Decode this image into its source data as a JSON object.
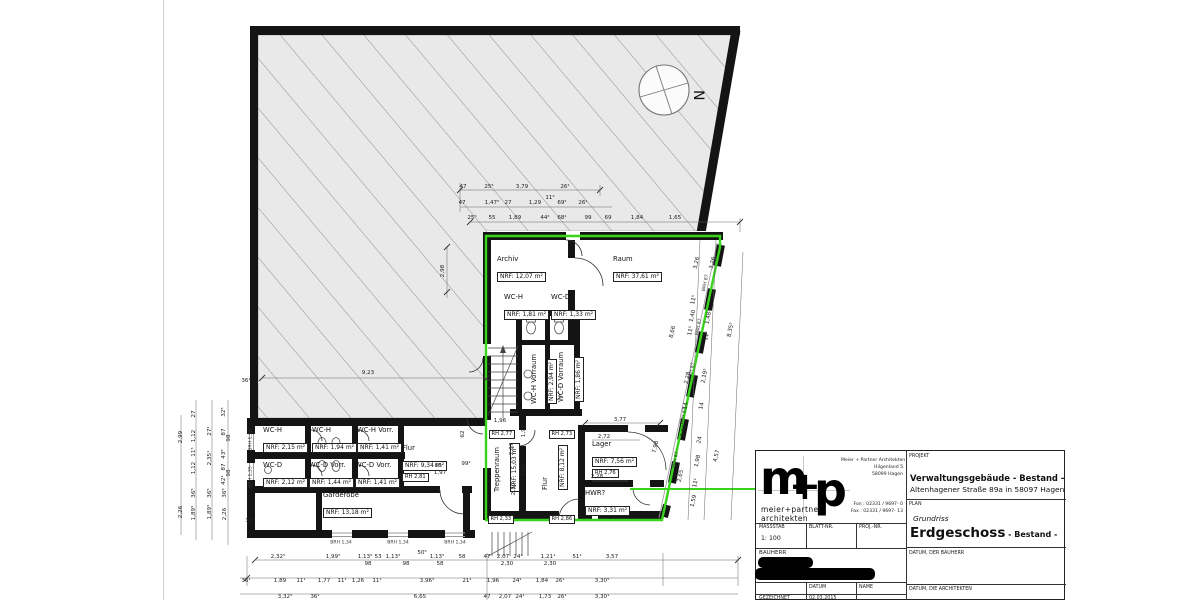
{
  "titleblock": {
    "logo": {
      "m": "m",
      "plus": "+",
      "p": "p",
      "line1": "meier+partner",
      "line2": "architekten"
    },
    "address": [
      "Meier + Partner Architekten",
      "Hilgenland 5",
      "58099 Hagen"
    ],
    "phone": [
      "Fon : 02331 / 9697- 0",
      "Fax : 02331 / 9697- 13"
    ],
    "fields": {
      "massstab_label": "MASSSTAB",
      "massstab_value": "1: 100",
      "blattnr_label": "BLATT-NR.",
      "projnr_label": "PROJ.-NR.",
      "bauherr_label": "BAUHERR",
      "datum_label": "DATUM",
      "name_label": "NAME",
      "gezeichnet_label": "GEZEICHNET",
      "gezeichnet_datum": "02.03.2015",
      "projekt_label": "PROJEKT",
      "projekt_title": "Verwaltungsgebäude - Bestand -",
      "projekt_sub": "Altenhagener Straße 89a in 58097 Hagen",
      "plan_label": "PLAN",
      "plan_type": "Grundriss",
      "plan_title": "Erdgeschoss",
      "plan_suffix": " - Bestand -",
      "datum_bauherr_label": "DATUM, DER BAUHERR",
      "datum_architekten_label": "DATUM, DIE ARCHITEKTEN"
    }
  },
  "plan": {
    "north_label": "N",
    "accent_green": "#38d41c",
    "rooms": [
      {
        "name": "Archiv",
        "area": "NRF: 12,07 m²",
        "x": 497,
        "y": 255
      },
      {
        "name": "Raum",
        "area": "NRF: 37,61 m²",
        "x": 613,
        "y": 255
      },
      {
        "name": "WC-H",
        "area": "NRF: 1,81 m²",
        "x": 504,
        "y": 293
      },
      {
        "name": "WC-D",
        "area": "NRF: 1,33 m²",
        "x": 551,
        "y": 293
      },
      {
        "name": "WC-H Vorraum",
        "area": "NRF: 2,94 m²",
        "x": 530,
        "y": 404,
        "r": -90
      },
      {
        "name": "WC-D Vorraum",
        "area": "NRF: 1,86 m²",
        "x": 557,
        "y": 402,
        "r": -90
      },
      {
        "name": "Treppenraum",
        "area": "NRF: 15,03 m²",
        "x": 493,
        "y": 492,
        "r": -90
      },
      {
        "name": "Flur",
        "area": "NRF: 8,12 m²",
        "x": 541,
        "y": 490,
        "r": -90
      },
      {
        "name": "Lager",
        "area": "NRF: 7,56 m²",
        "rh": "RH 2,76",
        "x": 592,
        "y": 440
      },
      {
        "name": "HWR?",
        "area": "NRF: 3,31 m²",
        "x": 585,
        "y": 489
      },
      {
        "name": "WC-H",
        "area": "NRF: 2,15 m²",
        "x": 263,
        "y": 426
      },
      {
        "name": "WC-H",
        "area": "NRF: 1,94 m²",
        "x": 312,
        "y": 426
      },
      {
        "name": "WC-H Vorr.",
        "area": "NRF: 1,41 m²",
        "x": 357,
        "y": 426
      },
      {
        "name": "WC-D",
        "area": "NRF: 2,12 m²",
        "x": 263,
        "y": 461
      },
      {
        "name": "WC-D Vorr.",
        "area": "NRF: 1,44 m²",
        "x": 309,
        "y": 461
      },
      {
        "name": "WC-D Vorr.",
        "area": "NRF: 1,41 m²",
        "x": 355,
        "y": 461
      },
      {
        "name": "Flur",
        "area": "NRF: 9,34 m²",
        "rh": "RH 2,81",
        "x": 402,
        "y": 444
      },
      {
        "name": "Garderobe",
        "area": "NRF: 13,18 m²",
        "x": 323,
        "y": 491
      }
    ],
    "rh_boxes": [
      {
        "t": "RH 2,77",
        "x": 489,
        "y": 430
      },
      {
        "t": "RH 2,73",
        "x": 549,
        "y": 430
      },
      {
        "t": "RH 2,33",
        "x": 488,
        "y": 515
      },
      {
        "t": "RH 2,86",
        "x": 549,
        "y": 515
      }
    ],
    "brh_labels": [
      {
        "t": "BRH 87",
        "x": 706,
        "y": 283,
        "r": -78
      },
      {
        "t": "BRH 87",
        "x": 699,
        "y": 327,
        "r": -78
      },
      {
        "t": "BRH 87",
        "x": 692,
        "y": 371,
        "r": -78
      },
      {
        "t": "BRH 87",
        "x": 684,
        "y": 416,
        "r": -78
      },
      {
        "t": "BRH 87",
        "x": 676,
        "y": 460,
        "r": -78
      },
      {
        "t": "BRH 1,34",
        "x": 341,
        "y": 543
      },
      {
        "t": "BRH 1,34",
        "x": 398,
        "y": 543
      },
      {
        "t": "BRH 1,34",
        "x": 455,
        "y": 543
      },
      {
        "t": "BRH 1,36",
        "x": 251,
        "y": 440,
        "r": -90
      },
      {
        "t": "BRH 1,35",
        "x": 251,
        "y": 477,
        "r": -90
      }
    ],
    "dims": [
      {
        "t": "47",
        "x": 463,
        "y": 187
      },
      {
        "t": "25⁵",
        "x": 489,
        "y": 187
      },
      {
        "t": "3,79",
        "x": 522,
        "y": 187
      },
      {
        "t": "26¹",
        "x": 565,
        "y": 187
      },
      {
        "t": "47",
        "x": 462,
        "y": 203
      },
      {
        "t": "1,47⁵",
        "x": 492,
        "y": 203
      },
      {
        "t": "27",
        "x": 508,
        "y": 203
      },
      {
        "t": "1,29",
        "x": 535,
        "y": 203
      },
      {
        "t": "11⁵",
        "x": 550,
        "y": 198
      },
      {
        "t": "69²",
        "x": 562,
        "y": 203
      },
      {
        "t": "26¹",
        "x": 583,
        "y": 203
      },
      {
        "t": "25⁵",
        "x": 472,
        "y": 218
      },
      {
        "t": "55",
        "x": 492,
        "y": 218
      },
      {
        "t": "1,89",
        "x": 515,
        "y": 218
      },
      {
        "t": "44²",
        "x": 545,
        "y": 218
      },
      {
        "t": "68¹",
        "x": 562,
        "y": 218
      },
      {
        "t": "99",
        "x": 588,
        "y": 218
      },
      {
        "t": "69",
        "x": 608,
        "y": 218
      },
      {
        "t": "1,84",
        "x": 637,
        "y": 218
      },
      {
        "t": "1,65",
        "x": 675,
        "y": 218
      },
      {
        "t": "9,23",
        "x": 368,
        "y": 373
      },
      {
        "t": "2,98",
        "x": 443,
        "y": 271,
        "r": -90
      },
      {
        "t": "36¹",
        "x": 246,
        "y": 381
      },
      {
        "t": "36⁵",
        "x": 250,
        "y": 521
      },
      {
        "t": "1,96",
        "x": 500,
        "y": 421
      },
      {
        "t": "62",
        "x": 463,
        "y": 434,
        "r": -90
      },
      {
        "t": "86",
        "x": 438,
        "y": 466
      },
      {
        "t": "1,97",
        "x": 440,
        "y": 473
      },
      {
        "t": "99²",
        "x": 466,
        "y": 464
      },
      {
        "t": "3,77",
        "x": 620,
        "y": 420
      },
      {
        "t": "2,72",
        "x": 604,
        "y": 437
      },
      {
        "t": "2,28",
        "x": 597,
        "y": 477
      },
      {
        "t": "2,07",
        "x": 512,
        "y": 449,
        "r": -90
      },
      {
        "t": "2,30",
        "x": 514,
        "y": 489,
        "r": -90
      },
      {
        "t": "1,92",
        "x": 524,
        "y": 431,
        "r": -90
      },
      {
        "t": "2,06",
        "x": 524,
        "y": 470,
        "r": -90
      },
      {
        "t": "8,66",
        "x": 673,
        "y": 332,
        "r": -78
      },
      {
        "t": "7,98",
        "x": 656,
        "y": 447,
        "r": -78
      },
      {
        "t": "2,99",
        "x": 181,
        "y": 437,
        "r": -90
      },
      {
        "t": "2,26",
        "x": 181,
        "y": 512,
        "r": -90
      },
      {
        "t": "27",
        "x": 194,
        "y": 414,
        "r": -90
      },
      {
        "t": "1,12",
        "x": 194,
        "y": 436,
        "r": -90
      },
      {
        "t": "11⁵",
        "x": 194,
        "y": 452,
        "r": -90
      },
      {
        "t": "1,12",
        "x": 194,
        "y": 468,
        "r": -90
      },
      {
        "t": "36⁵",
        "x": 194,
        "y": 493,
        "r": -90
      },
      {
        "t": "1,89⁵",
        "x": 194,
        "y": 513,
        "r": -90
      },
      {
        "t": "32⁵",
        "x": 224,
        "y": 412,
        "r": -90
      },
      {
        "t": "27¹",
        "x": 210,
        "y": 431,
        "r": -90
      },
      {
        "t": "2,35¹",
        "x": 210,
        "y": 458,
        "r": -90
      },
      {
        "t": "36⁵",
        "x": 210,
        "y": 493,
        "r": -90
      },
      {
        "t": "1,89⁵",
        "x": 210,
        "y": 512,
        "r": -90
      },
      {
        "t": "87",
        "x": 224,
        "y": 432,
        "r": -90
      },
      {
        "t": "98",
        "x": 229,
        "y": 438,
        "r": -90
      },
      {
        "t": "43⁵",
        "x": 224,
        "y": 454,
        "r": -90
      },
      {
        "t": "87",
        "x": 224,
        "y": 467,
        "r": -90
      },
      {
        "t": "98",
        "x": 229,
        "y": 473,
        "r": -90
      },
      {
        "t": "42¹",
        "x": 224,
        "y": 480,
        "r": -90
      },
      {
        "t": "36⁵",
        "x": 225,
        "y": 493,
        "r": -90
      },
      {
        "t": "2,26",
        "x": 225,
        "y": 514,
        "r": -90
      },
      {
        "t": "3,26",
        "x": 697,
        "y": 263,
        "r": -78
      },
      {
        "t": "11⁵",
        "x": 694,
        "y": 300,
        "r": -78
      },
      {
        "t": "1,40",
        "x": 693,
        "y": 316,
        "r": -78
      },
      {
        "t": "11⁵",
        "x": 691,
        "y": 331,
        "r": -78
      },
      {
        "t": "2,28",
        "x": 688,
        "y": 378,
        "r": -78
      },
      {
        "t": "14",
        "x": 686,
        "y": 406,
        "r": -78
      },
      {
        "t": "1,92",
        "x": 684,
        "y": 431,
        "r": -78
      },
      {
        "t": "2,65",
        "x": 681,
        "y": 476,
        "r": -78
      },
      {
        "t": "3,26",
        "x": 713,
        "y": 263,
        "r": -78
      },
      {
        "t": "1,48⁵",
        "x": 709,
        "y": 317,
        "r": -78
      },
      {
        "t": "11¹",
        "x": 707,
        "y": 336,
        "r": -78
      },
      {
        "t": "2,19⁵",
        "x": 705,
        "y": 376,
        "r": -78
      },
      {
        "t": "14",
        "x": 702,
        "y": 406,
        "r": -78
      },
      {
        "t": "24",
        "x": 700,
        "y": 440,
        "r": -78
      },
      {
        "t": "1,98",
        "x": 698,
        "y": 461,
        "r": -78
      },
      {
        "t": "11¹",
        "x": 696,
        "y": 483,
        "r": -78
      },
      {
        "t": "1,59",
        "x": 694,
        "y": 501,
        "r": -78
      },
      {
        "t": "8,35⁵",
        "x": 731,
        "y": 330,
        "r": -78
      },
      {
        "t": "4,57",
        "x": 717,
        "y": 456,
        "r": -78
      },
      {
        "t": "2,32⁵",
        "x": 278,
        "y": 557
      },
      {
        "t": "1,99⁵",
        "x": 333,
        "y": 557
      },
      {
        "t": "1,13⁵",
        "x": 365,
        "y": 557
      },
      {
        "t": "53",
        "x": 378,
        "y": 557
      },
      {
        "t": "1,13⁵",
        "x": 393,
        "y": 557
      },
      {
        "t": "50⁵",
        "x": 422,
        "y": 553
      },
      {
        "t": "1,13⁵",
        "x": 437,
        "y": 557
      },
      {
        "t": "58",
        "x": 462,
        "y": 557
      },
      {
        "t": "47",
        "x": 487,
        "y": 557
      },
      {
        "t": "2,07",
        "x": 503,
        "y": 557
      },
      {
        "t": "24¹",
        "x": 518,
        "y": 557
      },
      {
        "t": "1,21¹",
        "x": 548,
        "y": 557
      },
      {
        "t": "51¹",
        "x": 577,
        "y": 557
      },
      {
        "t": "3,57",
        "x": 612,
        "y": 557
      },
      {
        "t": "98",
        "x": 368,
        "y": 564
      },
      {
        "t": "98",
        "x": 406,
        "y": 564
      },
      {
        "t": "58",
        "x": 440,
        "y": 564
      },
      {
        "t": "2,30",
        "x": 507,
        "y": 564
      },
      {
        "t": "2,30",
        "x": 550,
        "y": 564
      },
      {
        "t": "36¹",
        "x": 246,
        "y": 581
      },
      {
        "t": "1,89",
        "x": 280,
        "y": 581
      },
      {
        "t": "11¹",
        "x": 301,
        "y": 581
      },
      {
        "t": "1,77",
        "x": 324,
        "y": 581
      },
      {
        "t": "11¹",
        "x": 342,
        "y": 581
      },
      {
        "t": "1,26",
        "x": 358,
        "y": 581
      },
      {
        "t": "11¹",
        "x": 377,
        "y": 581
      },
      {
        "t": "3,96⁵",
        "x": 427,
        "y": 581
      },
      {
        "t": "21¹",
        "x": 467,
        "y": 581
      },
      {
        "t": "1,96",
        "x": 493,
        "y": 581
      },
      {
        "t": "24¹",
        "x": 517,
        "y": 581
      },
      {
        "t": "1,84",
        "x": 542,
        "y": 581
      },
      {
        "t": "26¹",
        "x": 560,
        "y": 581
      },
      {
        "t": "3,30⁵",
        "x": 602,
        "y": 581
      },
      {
        "t": "3,32⁵",
        "x": 285,
        "y": 597
      },
      {
        "t": "36¹",
        "x": 315,
        "y": 597
      },
      {
        "t": "6,65",
        "x": 420,
        "y": 597
      },
      {
        "t": "47",
        "x": 487,
        "y": 597
      },
      {
        "t": "2,07",
        "x": 505,
        "y": 597
      },
      {
        "t": "24¹",
        "x": 520,
        "y": 597
      },
      {
        "t": "1,73",
        "x": 545,
        "y": 597
      },
      {
        "t": "26¹",
        "x": 562,
        "y": 597
      },
      {
        "t": "3,30¹",
        "x": 602,
        "y": 597
      }
    ]
  }
}
